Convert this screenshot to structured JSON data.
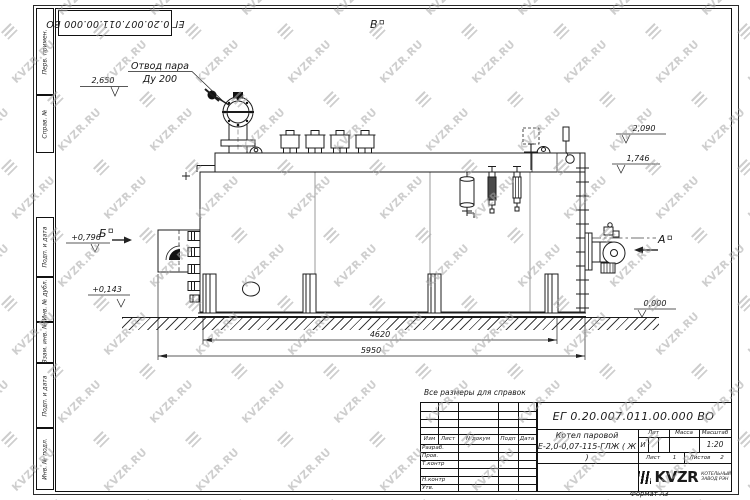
{
  "watermark": {
    "text": "KVZR.RU"
  },
  "corner_stamp": {
    "doc_number": "ЕГ 0.20.007.011.00.000  ВО"
  },
  "side_column": {
    "cells": [
      "Перв. примен.",
      "Справ. №",
      "Подп. и дата",
      "Инв. № дубл.",
      "Взам. инв. №",
      "Подп. и дата",
      "Инв. № подл."
    ]
  },
  "annotations": {
    "note": "Все размеры для справок",
    "steam_outlet": {
      "line1": "Отвод пара",
      "line2": "Ду 200"
    },
    "views": {
      "top": "В",
      "left": "Б",
      "right": "А"
    },
    "elevations": {
      "valve_top": "2,650",
      "right_upper": "2,090",
      "right_lower": "1,746",
      "left_upper": "+0,796",
      "left_lower": "+0,143",
      "ground": "0,000"
    },
    "dimensions": {
      "supports_span": "4620",
      "overall": "5950"
    }
  },
  "title_block": {
    "doc_number": "ЕГ 0.20.007.011.00.000  ВО",
    "product": {
      "line1": "Котел паровой",
      "line2": "Е-2,0-0,07-115-ГЛЖ ( Ж )"
    },
    "columns": {
      "izm": "Изм",
      "list": "Лист",
      "doc": "N докум",
      "sign": "Подп",
      "date": "Дата"
    },
    "rows": {
      "razrab": "Разраб.",
      "prov": "Пров.",
      "tkontr": "Т.контр",
      "nkontr": "Н.контр",
      "utv": "Утв."
    },
    "lit": {
      "label": "Лит",
      "value": "И"
    },
    "mass": {
      "label": "Масса",
      "value": ""
    },
    "scale": {
      "label": "Масштаб",
      "value": "1:20"
    },
    "sheet": {
      "label": "Лист",
      "value": "1"
    },
    "sheets": {
      "label": "Листов",
      "value": "2"
    },
    "company": {
      "name": "KVZR",
      "sub1": "КОТЕЛЬНЫЙ",
      "sub2": "ЗАВОД РЭН"
    },
    "format": "Формат А3"
  }
}
